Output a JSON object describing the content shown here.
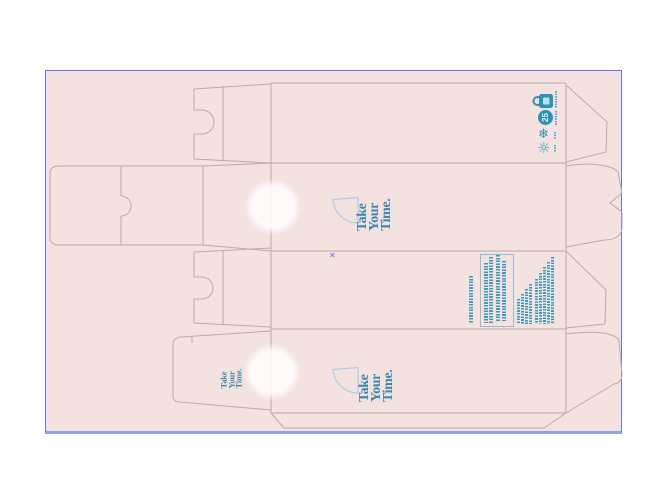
{
  "window": {
    "canvas_bg": "#ffffff"
  },
  "artboard": {
    "bg": "#f4e2e0",
    "border_color": "#5b78e8",
    "dieline_color": "#bcaaa9"
  },
  "brand": {
    "accent": "#3d87ad",
    "leaf_outline": "#abcfdf",
    "logo": {
      "word1": "Take",
      "word2": "Your",
      "word3": "Time."
    }
  },
  "storage_icons": {
    "color": "#2c92b8",
    "items": [
      {
        "name": "padlock-icon"
      },
      {
        "name": "temperature-limit-icon",
        "value": "25"
      },
      {
        "name": "snowflake-icon",
        "glyph": "❄"
      },
      {
        "name": "sunlight-icon",
        "glyph": "☼"
      }
    ]
  },
  "selection_marker": {
    "glyph": "✕",
    "color": "#5b6ee0"
  }
}
